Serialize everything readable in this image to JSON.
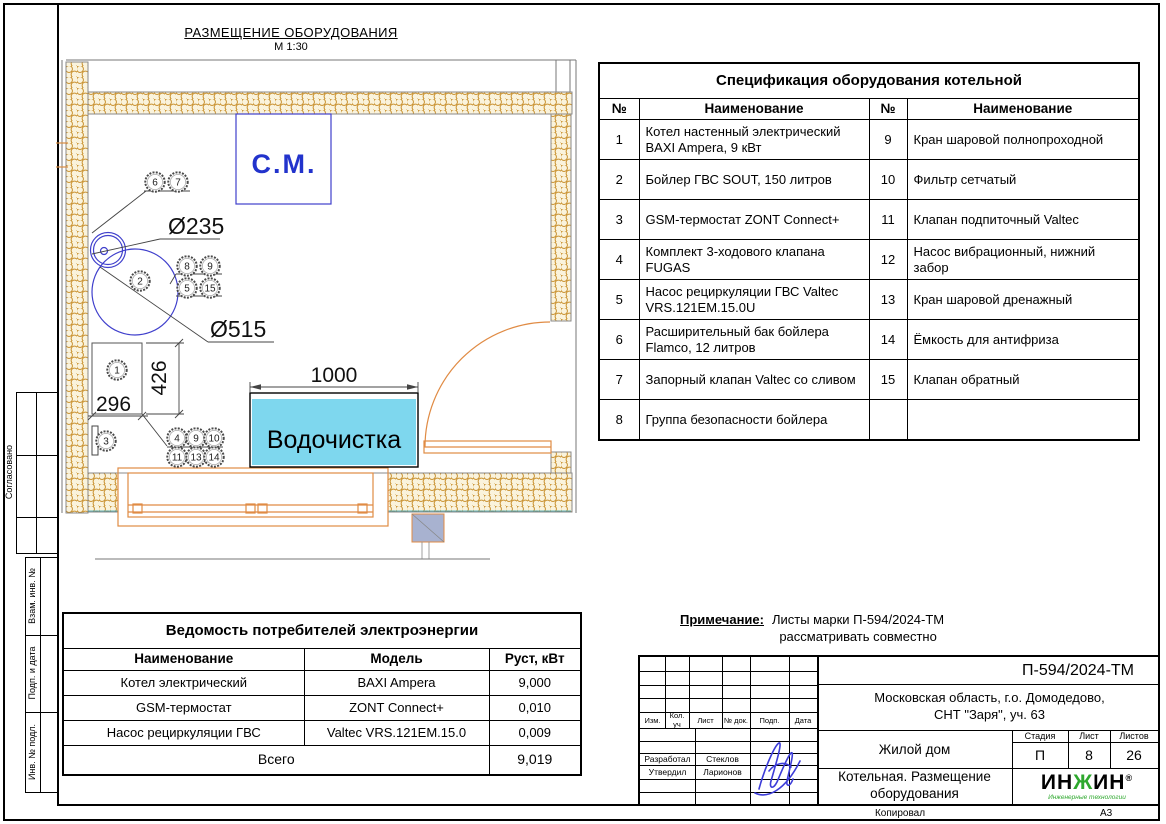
{
  "plan": {
    "title": "РАЗМЕЩЕНИЕ ОБОРУДОВАНИЯ",
    "scale": "М 1:30",
    "cm_label": "С.М.",
    "water_treatment_label": "Водочистка",
    "dim_d235": "Ø235",
    "dim_d515": "Ø515",
    "dim_1000": "1000",
    "dim_296": "296",
    "dim_426": "426",
    "callouts": [
      "6",
      "7",
      "8",
      "9",
      "5",
      "15",
      "2",
      "1",
      "3",
      "4",
      "9",
      "10",
      "11",
      "13",
      "14"
    ]
  },
  "spec_table": {
    "title": "Спецификация оборудования котельной",
    "headers": [
      "№",
      "Наименование",
      "№",
      "Наименование"
    ],
    "rows": [
      [
        "1",
        "Котел настенный электрический BAXI Ampera, 9 кВт",
        "9",
        "Кран шаровой полнопроходной"
      ],
      [
        "2",
        "Бойлер ГВС SOUT, 150 литров",
        "10",
        "Фильтр сетчатый"
      ],
      [
        "3",
        "GSM-термостат ZONT Connect+",
        "11",
        "Клапан подпиточный Valtec"
      ],
      [
        "4",
        "Комплект 3-ходового клапана FUGAS",
        "12",
        "Насос вибрационный, нижний забор"
      ],
      [
        "5",
        "Насос рециркуляции ГВС Valtec VRS.121EM.15.0U",
        "13",
        "Кран шаровой дренажный"
      ],
      [
        "6",
        "Расширительный бак бойлера Flamco, 12 литров",
        "14",
        "Ёмкость для антифриза"
      ],
      [
        "7",
        "Запорный клапан Valtec со сливом",
        "15",
        "Клапан обратный"
      ],
      [
        "8",
        "Группа безопасности бойлера",
        "",
        ""
      ]
    ]
  },
  "power_table": {
    "title": "Ведомость потребителей электроэнергии",
    "headers": [
      "Наименование",
      "Модель",
      "Руст, кВт"
    ],
    "rows": [
      [
        "Котел электрический",
        "BAXI Ampera",
        "9,000"
      ],
      [
        "GSM-термостат",
        "ZONT Connect+",
        "0,010"
      ],
      [
        "Насос рециркуляции ГВС",
        "Valtec VRS.121EM.15.0",
        "0,009"
      ]
    ],
    "total_label": "Всего",
    "total_value": "9,019"
  },
  "note": {
    "label": "Примечание:",
    "line1": "Листы марки П-594/2024-ТМ",
    "line2": "рассматривать совместно"
  },
  "title_block": {
    "doc_code": "П-594/2024-ТМ",
    "location_line1": "Московская область, г.о. Домодедово,",
    "location_line2": "СНТ \"Заря\", уч. 63",
    "object_name": "Жилой дом",
    "sheet_name_line1": "Котельная. Размещение",
    "sheet_name_line2": "оборудования",
    "stage_label": "Стадия",
    "sheet_label": "Лист",
    "sheets_label": "Листов",
    "stage_value": "П",
    "sheet_value": "8",
    "sheets_value": "26",
    "header_cells": [
      "Изм.",
      "Кол. уч",
      "Лист",
      "№ док.",
      "Подп.",
      "Дата"
    ],
    "developed_label": "Разработал",
    "developed_name": "Стеклов",
    "approved_label": "Утвердил",
    "approved_name": "Ларионов",
    "logo_part1": "ИН",
    "logo_part2": "Ж",
    "logo_part3": "ИН",
    "logo_reg": "®",
    "logo_subtitle": "Инженерные технологии"
  },
  "frame": {
    "left_labels": [
      "Согласовано",
      "Взам. инв. №",
      "Подп. и дата",
      "Инв. № подл."
    ],
    "copied_label": "Копировал",
    "format_label": "А3"
  },
  "colors": {
    "equipment_blue": "#4040cc",
    "water_cyan": "#7ed7ee",
    "wall_hatch_orange": "#c3861c",
    "joinery_orange": "#e08b44",
    "logo_green": "#2ea82e",
    "signature_blue": "#3c3cd8"
  }
}
